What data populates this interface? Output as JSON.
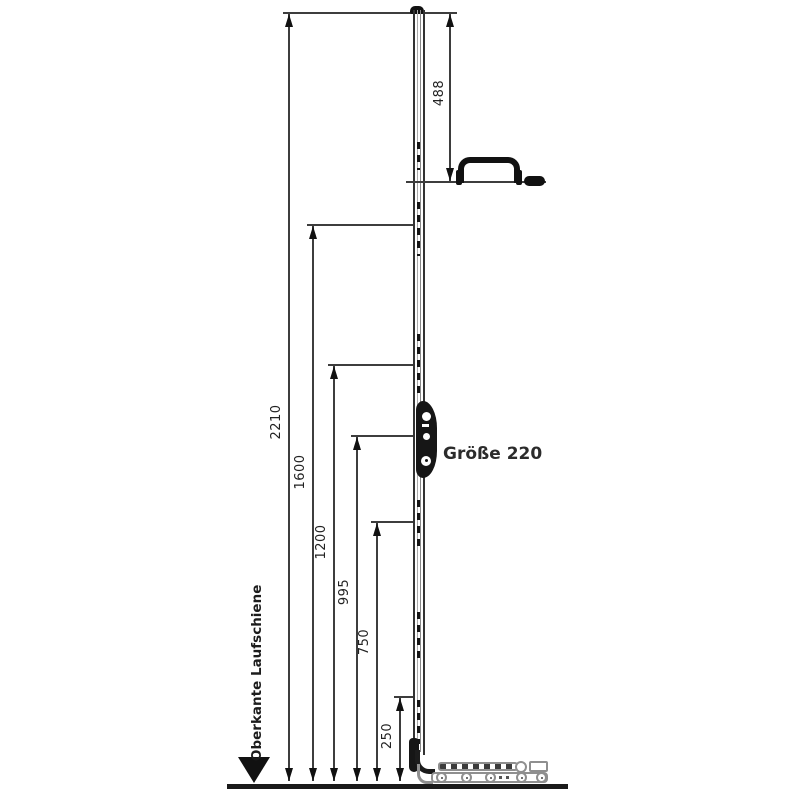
{
  "diagram": {
    "type": "technical dimension drawing (espagnolette / drive rod gear with handle and bottom track carriage)",
    "part_label": "Größe 220",
    "baseline_label": "Oberkante Laufschiene",
    "unit": "mm",
    "dims": {
      "d2210": "2210",
      "d1600": "1600",
      "d1200": "1200",
      "d995": "995",
      "d750": "750",
      "d488": "488",
      "d250": "250"
    },
    "colors": {
      "line": "#3d3d3d",
      "ink": "#141414",
      "hardware_gray": "#8f8f8f",
      "text": "#222222"
    }
  }
}
